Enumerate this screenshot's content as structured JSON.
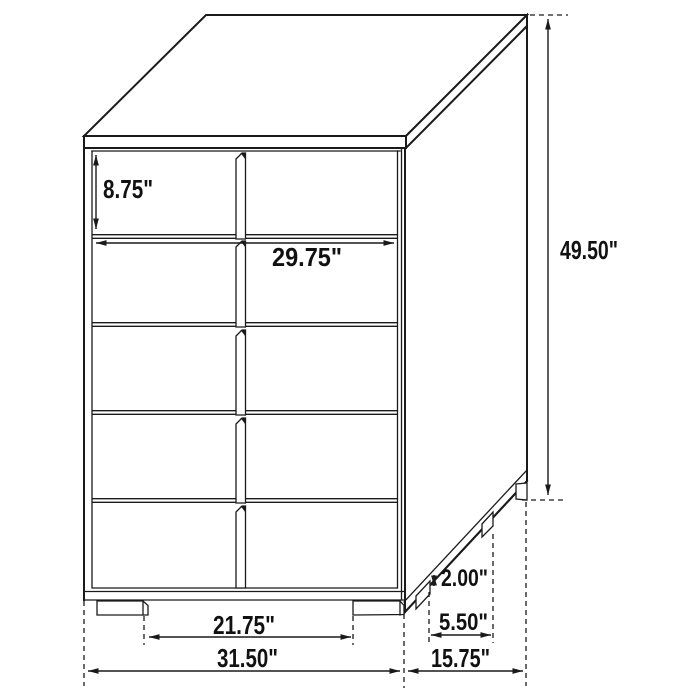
{
  "diagram": {
    "subject": "5-drawer chest dimension drawing",
    "colors": {
      "line": "#1a1a1a",
      "background": "#ffffff"
    },
    "dimensions": {
      "drawer_height": "8.75\"",
      "drawer_width": "29.75\"",
      "overall_height": "49.50\"",
      "leg_height": "2.00\"",
      "side_leg_spacing": "5.50\"",
      "front_leg_spacing": "21.75\"",
      "overall_width": "31.50\"",
      "overall_depth": "15.75\""
    }
  }
}
